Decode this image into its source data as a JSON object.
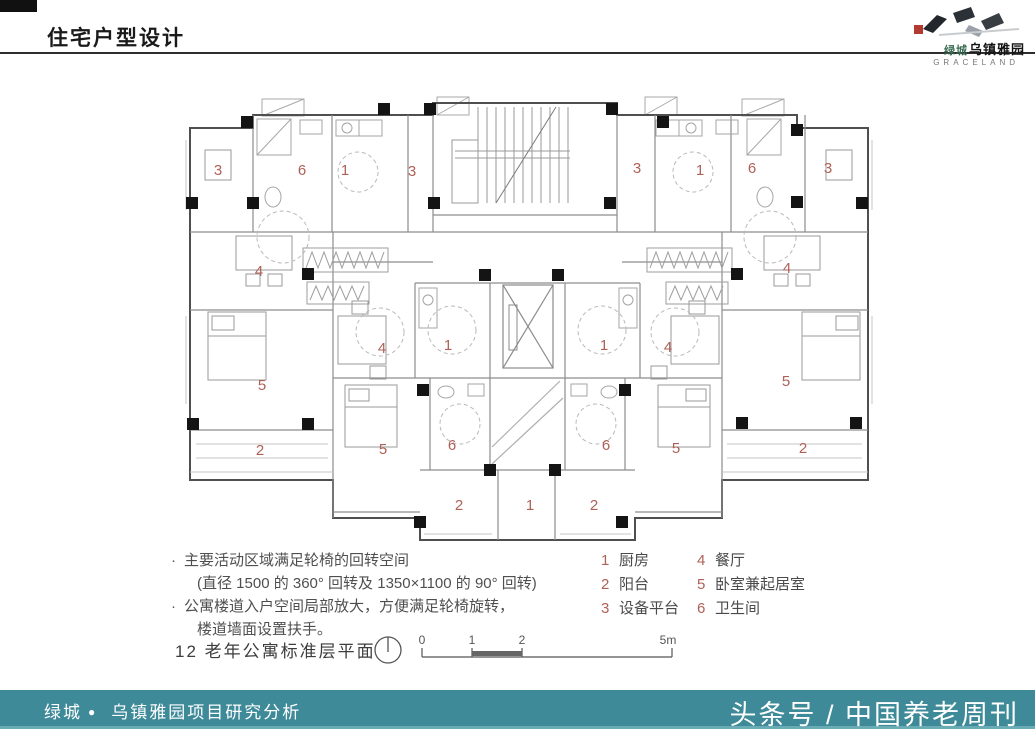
{
  "header": {
    "title": "住宅户型设计"
  },
  "logo": {
    "brand": "绿城",
    "name": "乌镇雅园",
    "subtitle": "GRACELAND"
  },
  "plan": {
    "caption": "12 老年公寓标准层平面",
    "notes": [
      {
        "bullet": "·",
        "text": "主要活动区域满足轮椅的回转空间",
        "indent": 0
      },
      {
        "bullet": "",
        "text": "(直径 1500 的 360° 回转及 1350×1100 的 90° 回转)",
        "indent": 1
      },
      {
        "bullet": "·",
        "text": "公寓楼道入户空间局部放大，方便满足轮椅旋转，",
        "indent": 0
      },
      {
        "bullet": "",
        "text": "楼道墙面设置扶手。",
        "indent": 1
      }
    ],
    "legend": [
      {
        "num": "1",
        "name": "厨房"
      },
      {
        "num": "2",
        "name": "阳台"
      },
      {
        "num": "3",
        "name": "设备平台"
      },
      {
        "num": "4",
        "name": "餐厅"
      },
      {
        "num": "5",
        "name": "卧室兼起居室"
      },
      {
        "num": "6",
        "name": "卫生间"
      }
    ],
    "room_labels": [
      {
        "n": "3",
        "x": 218,
        "y": 175
      },
      {
        "n": "6",
        "x": 302,
        "y": 175
      },
      {
        "n": "1",
        "x": 345,
        "y": 175
      },
      {
        "n": "3",
        "x": 412,
        "y": 176
      },
      {
        "n": "3",
        "x": 637,
        "y": 173
      },
      {
        "n": "1",
        "x": 700,
        "y": 175
      },
      {
        "n": "6",
        "x": 752,
        "y": 173
      },
      {
        "n": "3",
        "x": 828,
        "y": 173
      },
      {
        "n": "4",
        "x": 259,
        "y": 276
      },
      {
        "n": "4",
        "x": 787,
        "y": 273
      },
      {
        "n": "4",
        "x": 382,
        "y": 353
      },
      {
        "n": "4",
        "x": 668,
        "y": 352
      },
      {
        "n": "1",
        "x": 448,
        "y": 350
      },
      {
        "n": "1",
        "x": 604,
        "y": 350
      },
      {
        "n": "5",
        "x": 262,
        "y": 390
      },
      {
        "n": "5",
        "x": 786,
        "y": 386
      },
      {
        "n": "6",
        "x": 452,
        "y": 450
      },
      {
        "n": "6",
        "x": 606,
        "y": 450
      },
      {
        "n": "5",
        "x": 383,
        "y": 454
      },
      {
        "n": "5",
        "x": 676,
        "y": 453
      },
      {
        "n": "2",
        "x": 260,
        "y": 455
      },
      {
        "n": "2",
        "x": 803,
        "y": 453
      },
      {
        "n": "2",
        "x": 459,
        "y": 510
      },
      {
        "n": "1",
        "x": 530,
        "y": 510
      },
      {
        "n": "2",
        "x": 594,
        "y": 510
      }
    ],
    "scale_ticks": [
      {
        "label": "0",
        "x": 422
      },
      {
        "label": "1",
        "x": 472
      },
      {
        "label": "2",
        "x": 522
      },
      {
        "label": "5m",
        "x": 668
      }
    ]
  },
  "footer": {
    "brand": "绿城",
    "bullet": "●",
    "project": "乌镇雅园项目研究分析",
    "publisher": "头条号 / 中国养老周刊"
  },
  "colors": {
    "footer_bg": "#3e8a99",
    "room_number": "#ae6156",
    "wall": "#4f4f4f",
    "column": "#141414"
  }
}
